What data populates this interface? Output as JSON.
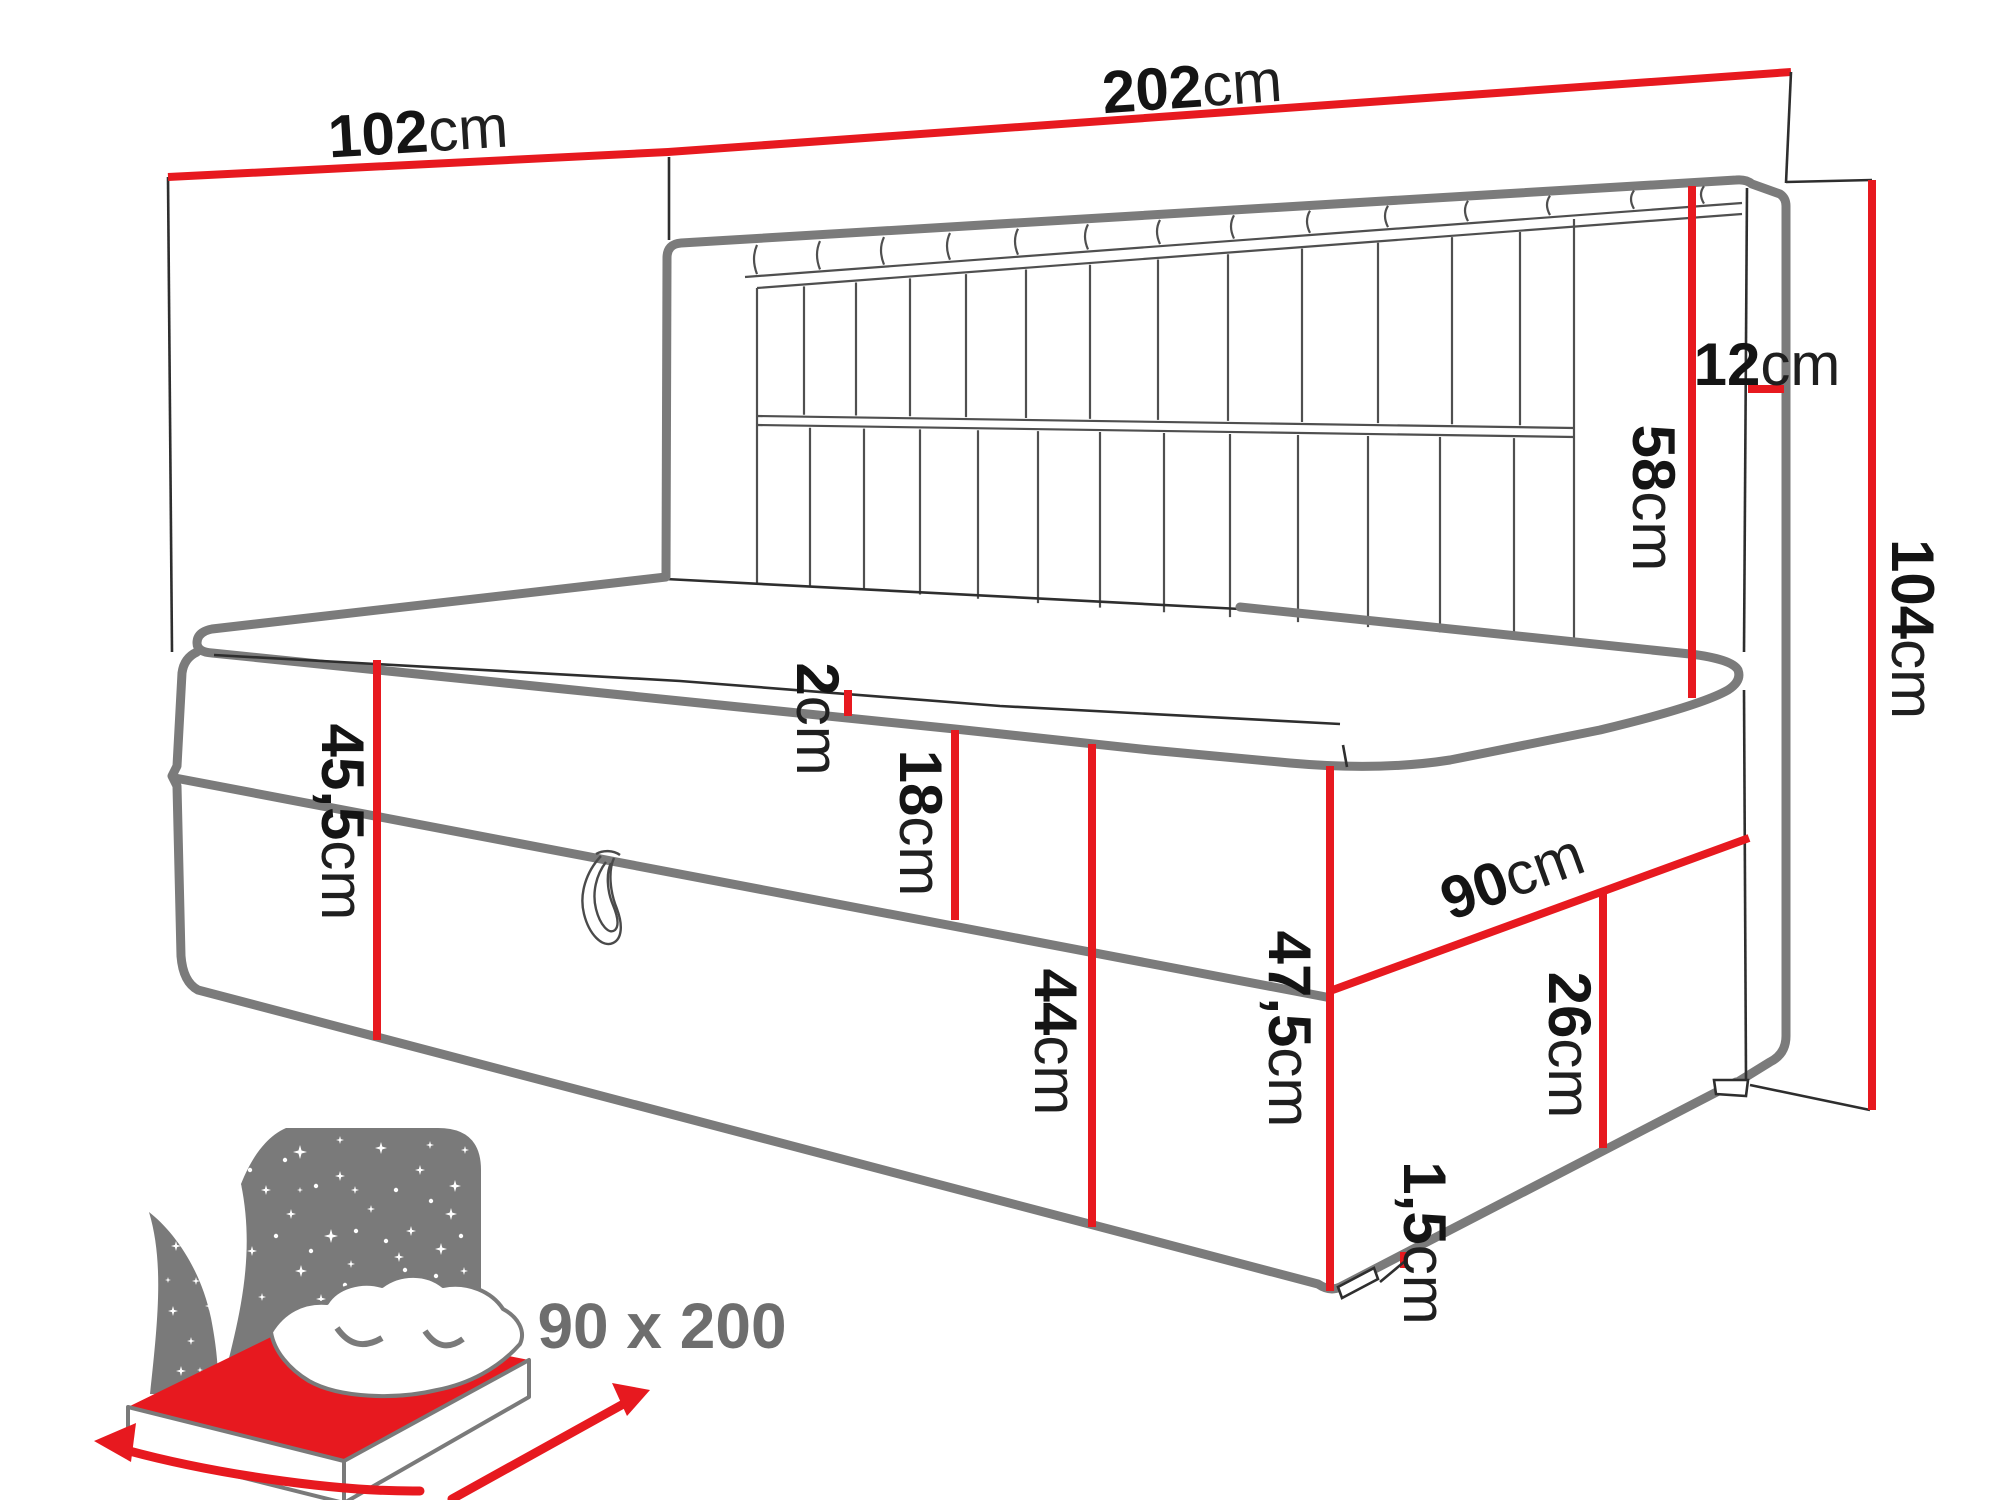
{
  "colors": {
    "accent_red": "#e7191f",
    "outline_gray": "#7b7b7b",
    "line_dark": "#2e2e2e",
    "icon_gray": "#7a7a7a",
    "label_ink": "#141414",
    "background": "#ffffff"
  },
  "measurements": {
    "length_total": {
      "value": "202",
      "unit": "cm"
    },
    "depth_total": {
      "value": "102",
      "unit": "cm"
    },
    "headboard_depth": {
      "value": "12",
      "unit": "cm"
    },
    "headboard_above": {
      "value": "58",
      "unit": "cm"
    },
    "height_total": {
      "value": "104",
      "unit": "cm"
    },
    "side_height": {
      "value": "45,5",
      "unit": "cm"
    },
    "topper": {
      "value": "2",
      "unit": "cm"
    },
    "upper_box": {
      "value": "18",
      "unit": "cm"
    },
    "front_height": {
      "value": "44",
      "unit": "cm"
    },
    "corner_height": {
      "value": "47,5",
      "unit": "cm"
    },
    "storage_height": {
      "value": "26",
      "unit": "cm"
    },
    "foot_height": {
      "value": "1,5",
      "unit": "cm"
    },
    "bed_width": {
      "value": "90",
      "unit": "cm"
    }
  },
  "icon": {
    "sleeping_area": "90 x 200"
  }
}
